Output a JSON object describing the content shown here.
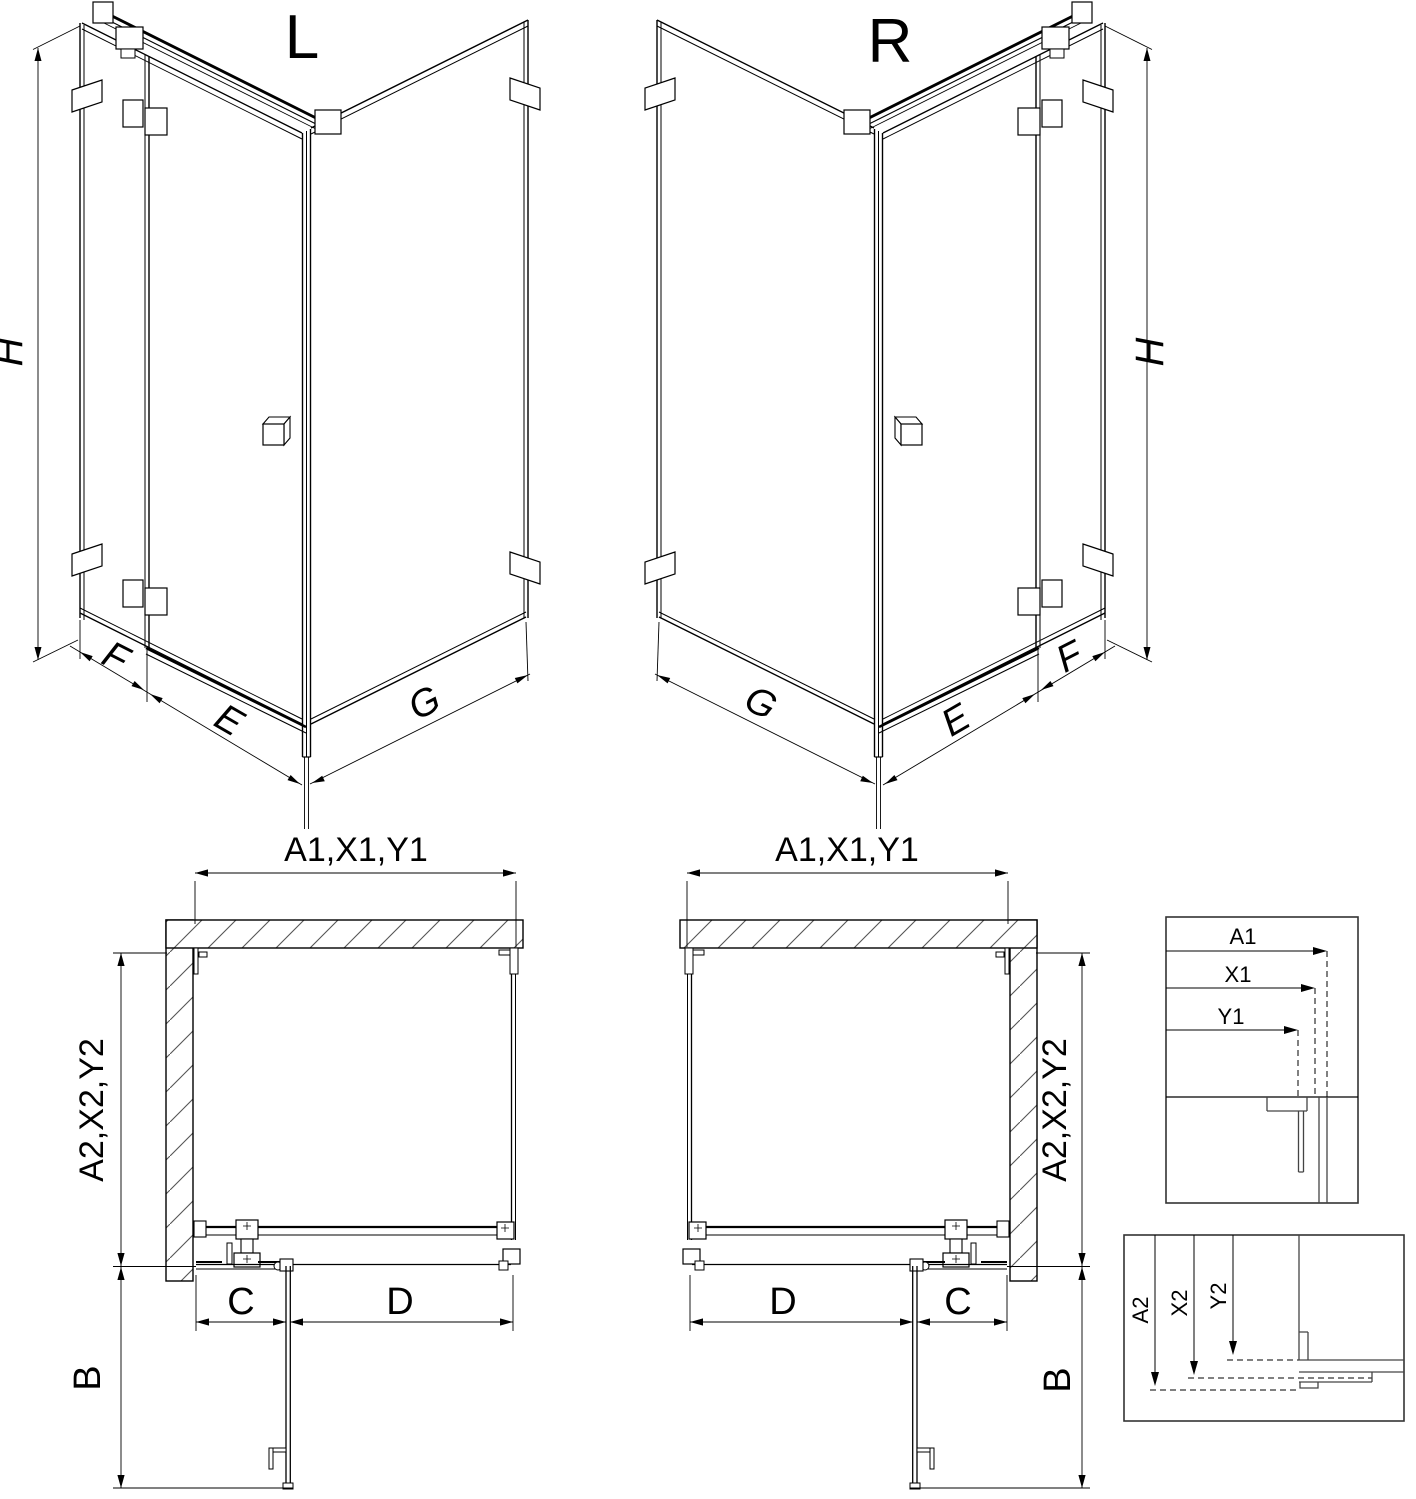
{
  "page": {
    "background": "#ffffff",
    "line_color": "#000000",
    "type": "shower-enclosure-technical-drawing"
  },
  "views": {
    "iso_left": {
      "label": "L",
      "dims": {
        "height": "H",
        "panel": "F",
        "door": "E",
        "side": "G"
      }
    },
    "iso_right": {
      "label": "R",
      "dims": {
        "height": "H",
        "panel": "F",
        "door": "E",
        "side": "G"
      }
    },
    "plan_left": {
      "dims": {
        "width": "A1,X1,Y1",
        "depth": "A2,X2,Y2",
        "door_swing": "B",
        "panel": "C",
        "door": "D"
      }
    },
    "plan_right": {
      "dims": {
        "width": "A1,X1,Y1",
        "depth": "A2,X2,Y2",
        "door_swing": "B",
        "panel": "C",
        "door": "D"
      }
    },
    "detail_width": {
      "labels": [
        "A1",
        "X1",
        "Y1"
      ]
    },
    "detail_depth": {
      "labels": [
        "A2",
        "X2",
        "Y2"
      ]
    }
  }
}
